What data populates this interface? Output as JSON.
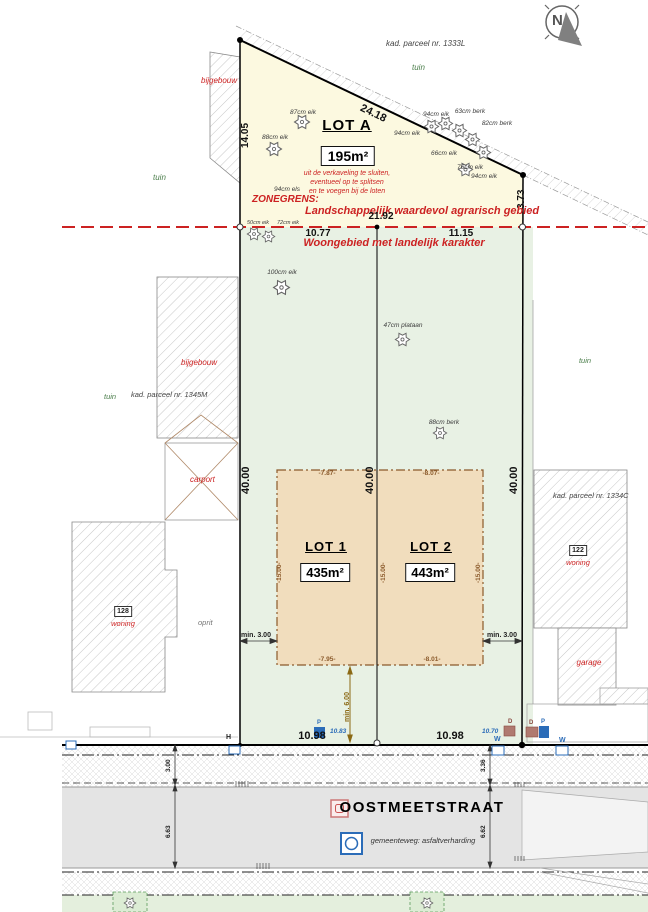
{
  "north_label": "N",
  "parcels": {
    "kad_top": "kad. parceel nr. 1333L",
    "kad_left": "kad. parceel nr. 1345M",
    "kad_right": "kad. parceel nr. 1334C",
    "tuin": "tuin",
    "bijgebouw": "bijgebouw",
    "carport": "carport",
    "oprit": "oprit",
    "woning": "woning",
    "garage": "garage",
    "house_left": "128",
    "house_right": "122"
  },
  "lots": {
    "lot_a": {
      "title": "LOT A",
      "area": "195m²"
    },
    "lot_1": {
      "title": "LOT 1",
      "area": "435m²"
    },
    "lot_2": {
      "title": "LOT 2",
      "area": "443m²"
    },
    "note_1": "uit de verkaveling te sluiten,",
    "note_2": "eventueel op te splitsen",
    "note_3": "en te voegen bij de loten"
  },
  "zones": {
    "zonegrens": "ZONEGRENS:",
    "north_zone": "Landschappelijk waardevol agrarisch gebied",
    "south_zone": "Woongebied met landelijk karakter"
  },
  "dims": {
    "top_diag": "24.18",
    "left_a": "14.05",
    "right_a": "3.73",
    "zone_width": "21.92",
    "front_a_left": "10.77",
    "front_a_right": "11.15",
    "side_40": "40.00",
    "env_top_1": "-7.87-",
    "env_top_2": "-8.07-",
    "env_bottom_1": "-7.95-",
    "env_bottom_2": "-8.01-",
    "env_side": "-15.00-",
    "min_side": "min. 3.00",
    "min_front": "min. 6.00",
    "front_left": "10.98",
    "front_right": "10.98",
    "verge_left": "3.00",
    "verge_right": "3.36",
    "road_left": "6.63",
    "road_right": "6.62"
  },
  "street": {
    "name": "OOSTMEETSTRAAT",
    "surface": "gemeenteweg: asfaltverharding"
  },
  "levels": {
    "left": "10.83",
    "right": "10.70"
  },
  "markers": {
    "h": "H",
    "p": "P",
    "d": "D",
    "w": "W"
  },
  "trees": [
    "87cm eik",
    "88cm eik",
    "94cm els",
    "50cm eik",
    "72cm eik",
    "94cm eik",
    "63cm berk",
    "82cm berk",
    "94cm eik",
    "66cm eik",
    "76cm eik",
    "94cm eik",
    "100cm eik",
    "47cm plataan",
    "88cm berk"
  ],
  "colors": {
    "zone_line": "#cc2222",
    "zone_text": "#cc2222",
    "lot_a_fill": "#fcf9e0",
    "lots_fill": "#e8f1e4",
    "envelope_fill": "#f1ddbd",
    "envelope_line": "#8b5a2b",
    "road_fill": "#e4e4e4",
    "marker_blue": "#2b6cb8",
    "marker_brown": "#b07a70"
  }
}
